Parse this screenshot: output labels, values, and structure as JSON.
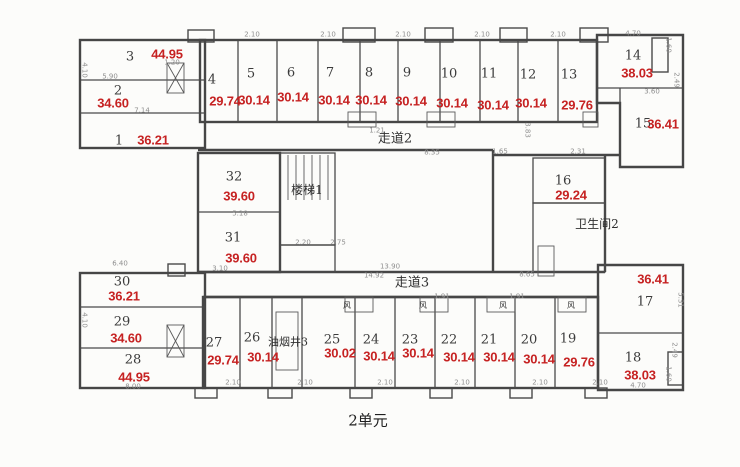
{
  "unit_label": "2单元",
  "colors": {
    "area_text": "#c62222",
    "walls": "#4a4a4a",
    "dimension_text": "#8f8f8f",
    "room_text": "#3b3b3b"
  },
  "rooms": [
    {
      "number": "1",
      "area": "36.21",
      "nx": 119,
      "ny": 141,
      "ax": 153,
      "ay": 140
    },
    {
      "number": "2",
      "area": "34.60",
      "nx": 118,
      "ny": 91,
      "ax": 113,
      "ay": 103
    },
    {
      "number": "3",
      "area": "44.95",
      "nx": 130,
      "ny": 57,
      "ax": 167,
      "ay": 54
    },
    {
      "number": "4",
      "area": "29.74",
      "nx": 212,
      "ny": 80,
      "ax": 225,
      "ay": 101
    },
    {
      "number": "5",
      "area": "30.14",
      "nx": 251,
      "ny": 74,
      "ax": 254,
      "ay": 100
    },
    {
      "number": "6",
      "area": "30.14",
      "nx": 291,
      "ny": 73,
      "ax": 293,
      "ay": 97
    },
    {
      "number": "7",
      "area": "30.14",
      "nx": 330,
      "ny": 73,
      "ax": 334,
      "ay": 100
    },
    {
      "number": "8",
      "area": "30.14",
      "nx": 369,
      "ny": 73,
      "ax": 371,
      "ay": 100
    },
    {
      "number": "9",
      "area": "30.14",
      "nx": 407,
      "ny": 73,
      "ax": 411,
      "ay": 101
    },
    {
      "number": "10",
      "area": "30.14",
      "nx": 449,
      "ny": 74,
      "ax": 452,
      "ay": 103
    },
    {
      "number": "11",
      "area": "30.14",
      "nx": 489,
      "ny": 74,
      "ax": 493,
      "ay": 105
    },
    {
      "number": "12",
      "area": "30.14",
      "nx": 528,
      "ny": 75,
      "ax": 531,
      "ay": 103
    },
    {
      "number": "13",
      "area": "29.76",
      "nx": 569,
      "ny": 75,
      "ax": 577,
      "ay": 105
    },
    {
      "number": "14",
      "area": "38.03",
      "nx": 633,
      "ny": 56,
      "ax": 637,
      "ay": 73
    },
    {
      "number": "15",
      "area": "36.41",
      "nx": 643,
      "ny": 124,
      "ax": 663,
      "ay": 124
    },
    {
      "number": "16",
      "area": "29.24",
      "nx": 563,
      "ny": 181,
      "ax": 571,
      "ay": 195
    },
    {
      "number": "17",
      "area": "36.41",
      "nx": 645,
      "ny": 302,
      "ax": 653,
      "ay": 279
    },
    {
      "number": "18",
      "area": "38.03",
      "nx": 633,
      "ny": 358,
      "ax": 640,
      "ay": 375
    },
    {
      "number": "19",
      "area": "29.76",
      "nx": 568,
      "ny": 339,
      "ax": 579,
      "ay": 362
    },
    {
      "number": "20",
      "area": "30.14",
      "nx": 529,
      "ny": 340,
      "ax": 539,
      "ay": 359
    },
    {
      "number": "21",
      "area": "30.14",
      "nx": 489,
      "ny": 340,
      "ax": 499,
      "ay": 357
    },
    {
      "number": "22",
      "area": "30.14",
      "nx": 449,
      "ny": 340,
      "ax": 459,
      "ay": 357
    },
    {
      "number": "23",
      "area": "30.14",
      "nx": 410,
      "ny": 340,
      "ax": 418,
      "ay": 353
    },
    {
      "number": "24",
      "area": "30.14",
      "nx": 371,
      "ny": 340,
      "ax": 379,
      "ay": 356
    },
    {
      "number": "25",
      "area": "30.02",
      "nx": 332,
      "ny": 340,
      "ax": 340,
      "ay": 353
    },
    {
      "number": "26",
      "area": "30.14",
      "nx": 252,
      "ny": 338,
      "ax": 263,
      "ay": 357
    },
    {
      "number": "27",
      "area": "29.74",
      "nx": 214,
      "ny": 343,
      "ax": 223,
      "ay": 360
    },
    {
      "number": "28",
      "area": "44.95",
      "nx": 133,
      "ny": 360,
      "ax": 134,
      "ay": 377
    },
    {
      "number": "29",
      "area": "34.60",
      "nx": 122,
      "ny": 322,
      "ax": 126,
      "ay": 338
    },
    {
      "number": "30",
      "area": "36.21",
      "nx": 122,
      "ny": 282,
      "ax": 124,
      "ay": 296
    },
    {
      "number": "31",
      "area": "39.60",
      "nx": 233,
      "ny": 238,
      "ax": 241,
      "ay": 258
    },
    {
      "number": "32",
      "area": "39.60",
      "nx": 234,
      "ny": 177,
      "ax": 239,
      "ay": 196
    }
  ],
  "annotations": [
    {
      "name": "corridor-2-label",
      "text": "走道2",
      "x": 395,
      "y": 139,
      "size": 13
    },
    {
      "name": "corridor-3-label",
      "text": "走道3",
      "x": 412,
      "y": 283,
      "size": 13
    },
    {
      "name": "stairs-1-label",
      "text": "楼梯1",
      "x": 307,
      "y": 190,
      "size": 12
    },
    {
      "name": "bathroom-2-label",
      "text": "卫生间2",
      "x": 597,
      "y": 224,
      "size": 12
    },
    {
      "name": "smoke-shaft-3-label",
      "text": "油烟井3",
      "x": 288,
      "y": 342,
      "size": 11
    },
    {
      "name": "air-shaft-label-1",
      "text": "风",
      "x": 347,
      "y": 306,
      "size": 8
    },
    {
      "name": "air-shaft-label-2",
      "text": "风",
      "x": 423,
      "y": 306,
      "size": 8
    },
    {
      "name": "air-shaft-label-3",
      "text": "风",
      "x": 503,
      "y": 306,
      "size": 8
    },
    {
      "name": "air-shaft-label-4",
      "text": "风",
      "x": 571,
      "y": 306,
      "size": 8
    }
  ],
  "dimensions": [
    {
      "t": "2.10",
      "x": 252,
      "y": 35
    },
    {
      "t": "2.10",
      "x": 328,
      "y": 35
    },
    {
      "t": "2.10",
      "x": 403,
      "y": 35
    },
    {
      "t": "2.10",
      "x": 482,
      "y": 35
    },
    {
      "t": "2.10",
      "x": 558,
      "y": 35
    },
    {
      "t": "4.70",
      "x": 633,
      "y": 34
    },
    {
      "t": "1.20",
      "x": 172,
      "y": 63
    },
    {
      "t": "5.90",
      "x": 110,
      "y": 77
    },
    {
      "t": "7.14",
      "x": 142,
      "y": 111
    },
    {
      "t": "1.21",
      "x": 377,
      "y": 131
    },
    {
      "t": "8.35",
      "x": 432,
      "y": 153
    },
    {
      "t": "1.65",
      "x": 500,
      "y": 152
    },
    {
      "t": "2.31",
      "x": 578,
      "y": 152
    },
    {
      "t": "3.60",
      "x": 652,
      "y": 92
    },
    {
      "t": "5.18",
      "x": 240,
      "y": 214
    },
    {
      "t": "2.20",
      "x": 303,
      "y": 243
    },
    {
      "t": "2.75",
      "x": 338,
      "y": 243
    },
    {
      "t": "13.90",
      "x": 390,
      "y": 267
    },
    {
      "t": "14.92",
      "x": 374,
      "y": 276
    },
    {
      "t": "8.65",
      "x": 527,
      "y": 275
    },
    {
      "t": "3.10",
      "x": 220,
      "y": 269
    },
    {
      "t": "6.40",
      "x": 120,
      "y": 264
    },
    {
      "t": "8.00",
      "x": 133,
      "y": 387
    },
    {
      "t": "2.10",
      "x": 233,
      "y": 383
    },
    {
      "t": "2.10",
      "x": 305,
      "y": 383
    },
    {
      "t": "2.10",
      "x": 385,
      "y": 383
    },
    {
      "t": "2.10",
      "x": 462,
      "y": 383
    },
    {
      "t": "2.10",
      "x": 540,
      "y": 383
    },
    {
      "t": "2.10",
      "x": 600,
      "y": 383
    },
    {
      "t": "4.70",
      "x": 638,
      "y": 386
    },
    {
      "t": "1.91",
      "x": 442,
      "y": 297
    },
    {
      "t": "1.91",
      "x": 517,
      "y": 297
    },
    {
      "t": "4.10",
      "x": 84,
      "y": 70,
      "r": 1
    },
    {
      "t": "4.10",
      "x": 84,
      "y": 320,
      "r": 1
    },
    {
      "t": "5.31",
      "x": 680,
      "y": 300,
      "r": 1
    },
    {
      "t": "2.49",
      "x": 676,
      "y": 80,
      "r": 1
    },
    {
      "t": "1.60",
      "x": 668,
      "y": 45,
      "r": 1
    },
    {
      "t": "2.49",
      "x": 674,
      "y": 350,
      "r": 1
    },
    {
      "t": "1.60",
      "x": 668,
      "y": 374,
      "r": 1
    },
    {
      "t": "3.83",
      "x": 527,
      "y": 130,
      "r": 1
    }
  ]
}
